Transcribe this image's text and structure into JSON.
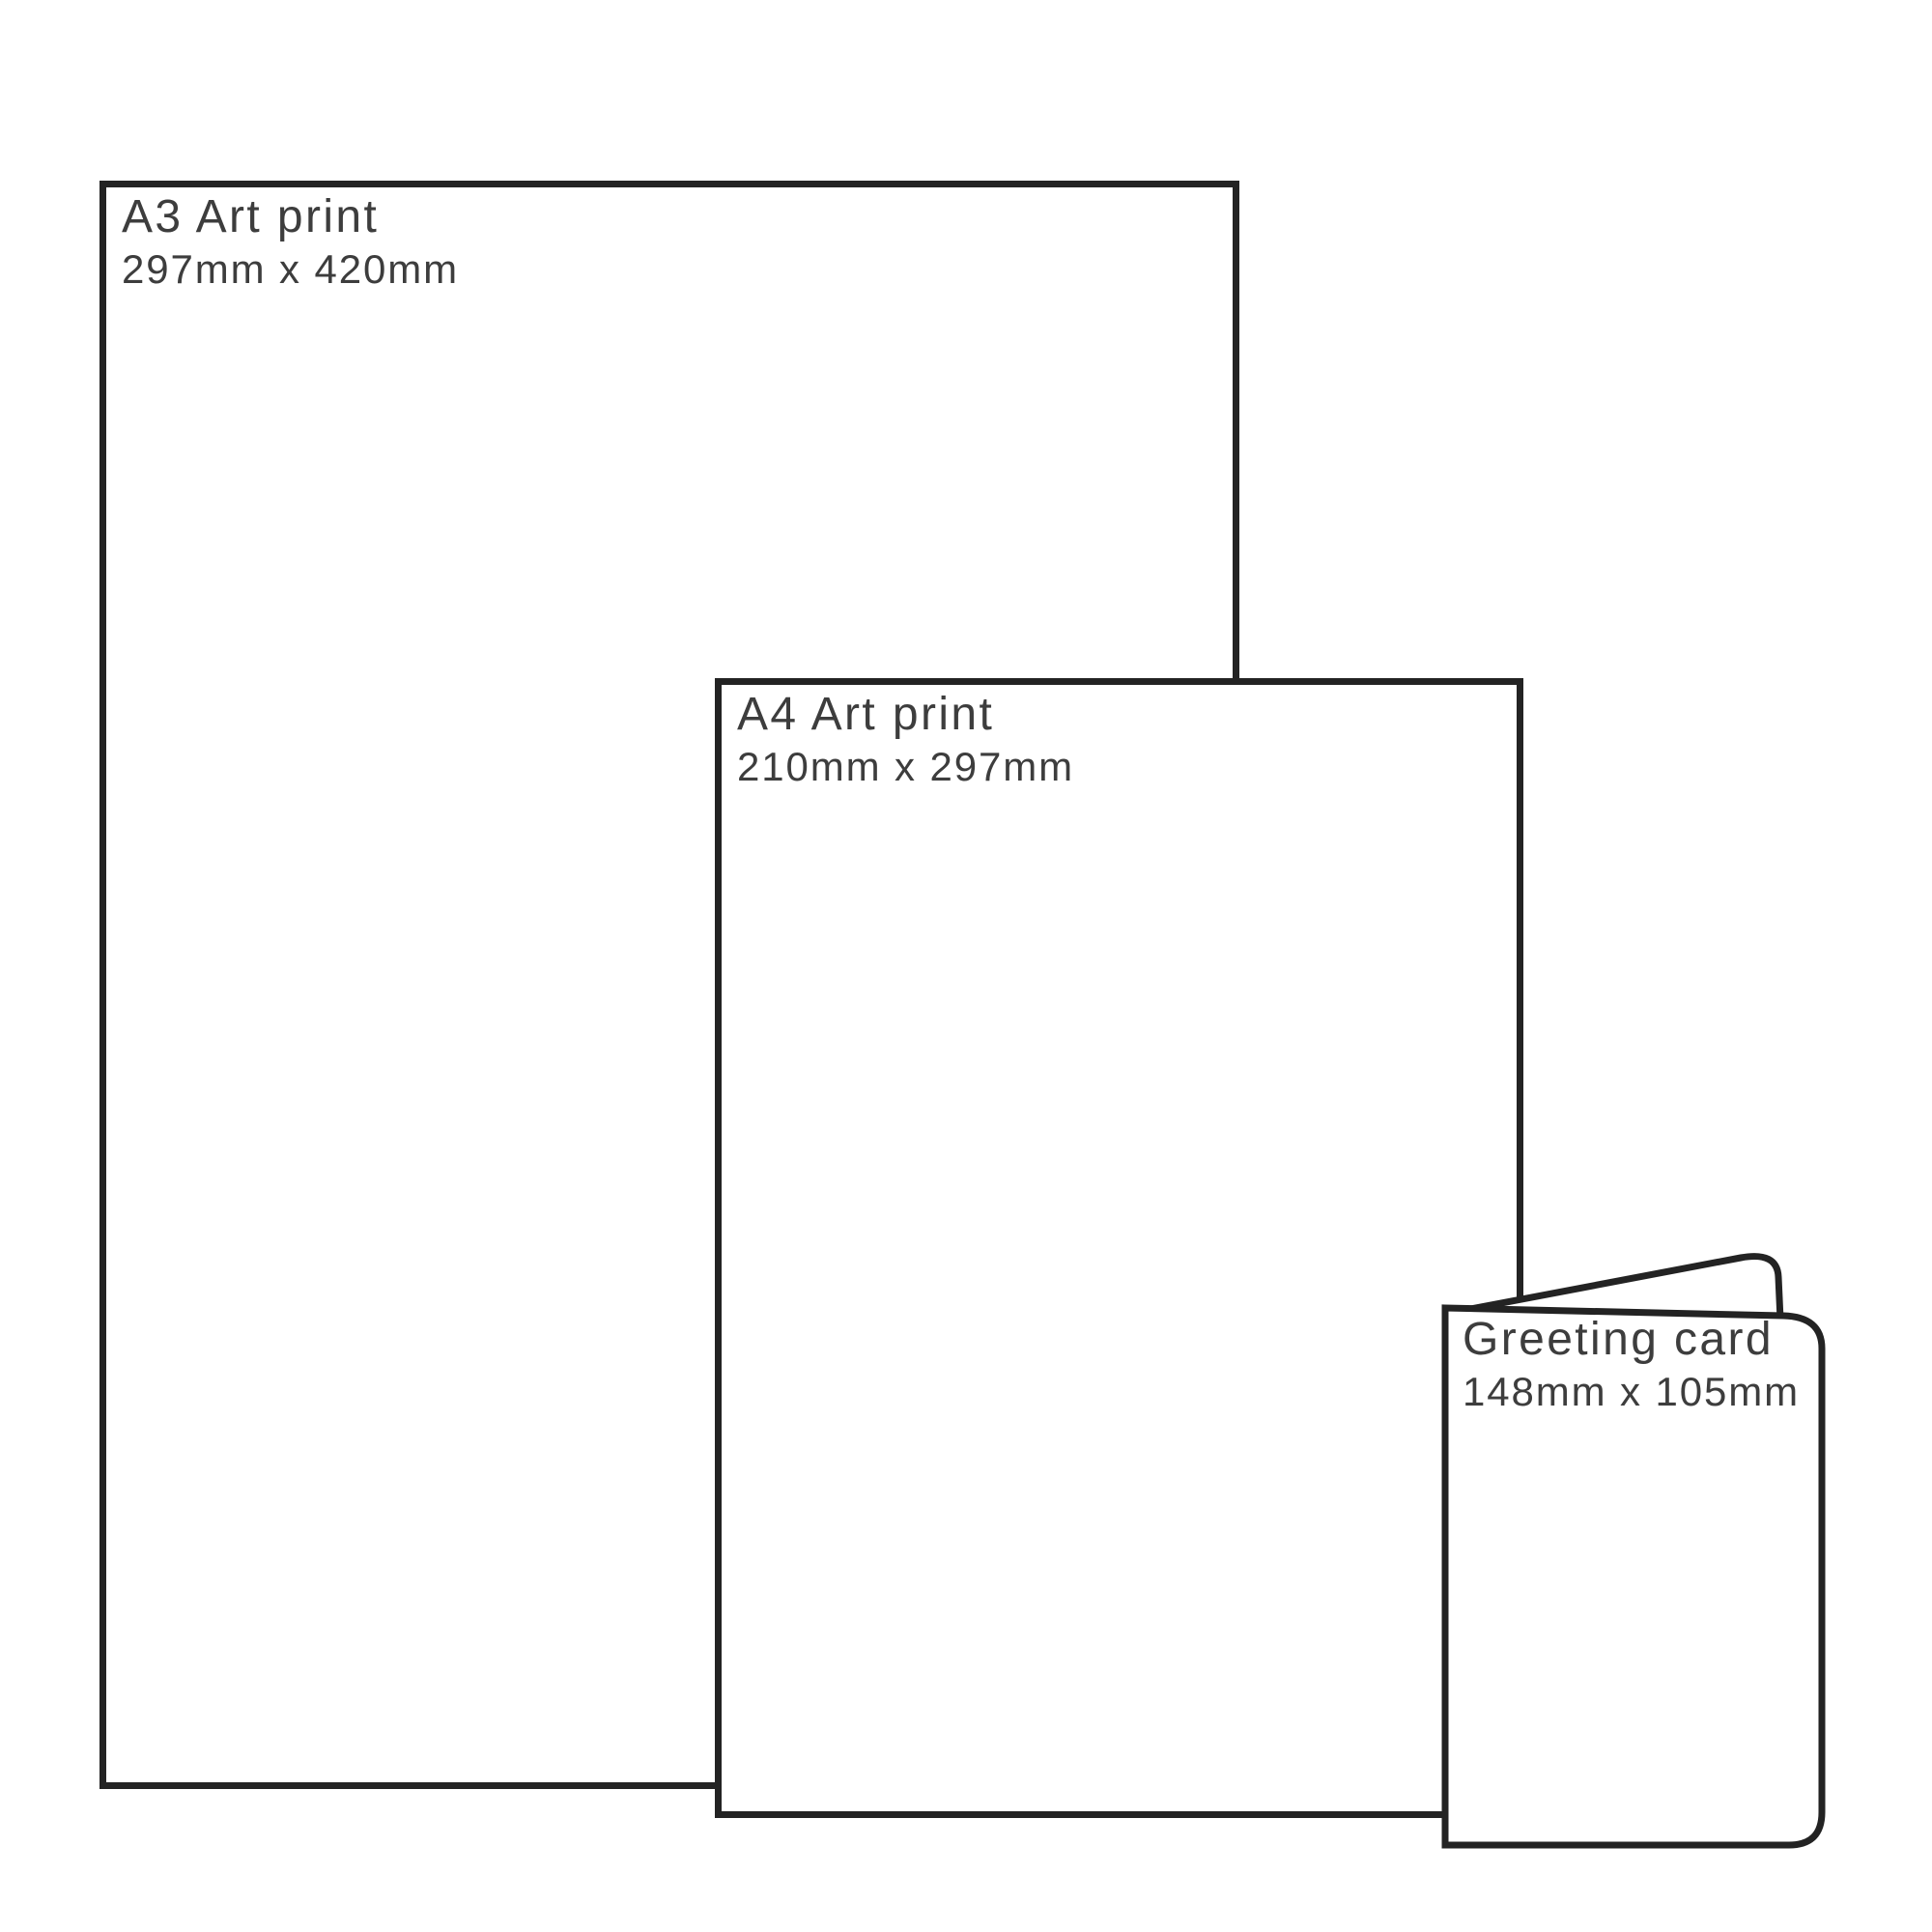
{
  "diagram": {
    "items": [
      {
        "id": "a3-print",
        "name": "A3 Art print",
        "dimensions": "297mm x 420mm"
      },
      {
        "id": "a4-print",
        "name": "A4 Art print",
        "dimensions": "210mm x 297mm"
      },
      {
        "id": "greeting-card",
        "name": "Greeting card",
        "dimensions": "148mm x 105mm"
      }
    ]
  },
  "theme": {
    "outline": "#232323",
    "text": "#3d3d3d",
    "background": "#ffffff"
  }
}
